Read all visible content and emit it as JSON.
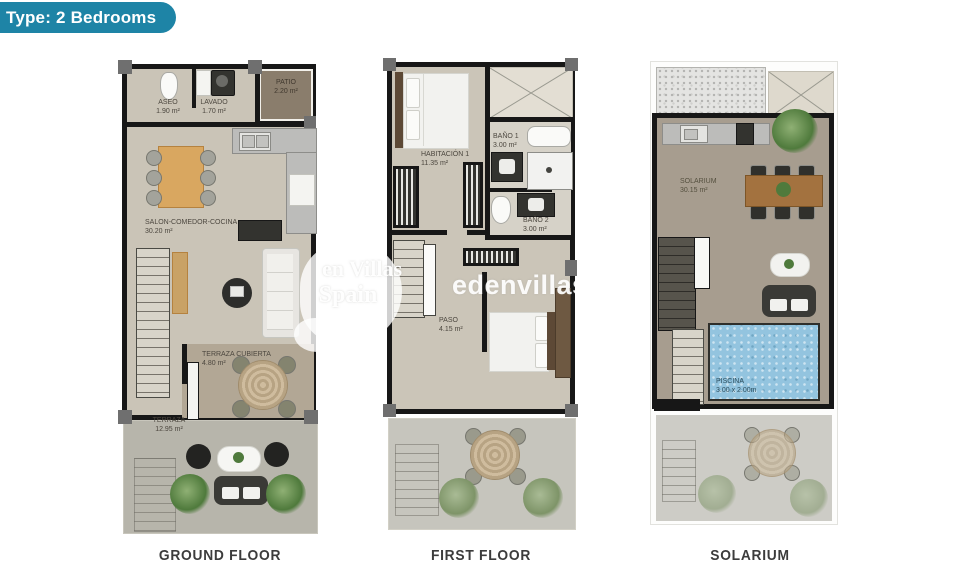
{
  "badge": {
    "label": "Type: 2 Bedrooms"
  },
  "watermark": {
    "logo_line1": "en Villas",
    "logo_line2": "Spain",
    "site_text": "edenvillasspain"
  },
  "plans": [
    {
      "caption": "GROUND FLOOR",
      "rooms": [
        {
          "name": "ASEO",
          "area": "1.90 m²"
        },
        {
          "name": "LAVADO",
          "area": "1.70 m²"
        },
        {
          "name": "PATIO",
          "area": "2.20 m²"
        },
        {
          "name": "SALON-COMEDOR-COCINA",
          "area": "30.20 m²"
        },
        {
          "name": "TERRAZA CUBIERTA",
          "area": "4.80 m²"
        },
        {
          "name": "TERRAZA",
          "area": "12.95 m²"
        }
      ]
    },
    {
      "caption": "FIRST FLOOR",
      "rooms": [
        {
          "name": "HABITACIÓN 1",
          "area": "11.35 m²"
        },
        {
          "name": "BAÑO 1",
          "area": "3.00 m²"
        },
        {
          "name": "BAÑO 2",
          "area": "3.00 m²"
        },
        {
          "name": "PASO",
          "area": "4.15 m²"
        }
      ]
    },
    {
      "caption": "SOLARIUM",
      "rooms": [
        {
          "name": "SOLARIUM",
          "area": "30.15 m²"
        },
        {
          "name": "PISCINA",
          "area": "3.00 x 2.00m"
        }
      ]
    }
  ],
  "colors": {
    "badge_teal": "#1e84a6",
    "wall_black": "#171717",
    "floor_beige": "#cac4b7",
    "patio_brown": "#8a7d6c",
    "pool_blue": "#93c4df",
    "wood": "#d9a760"
  }
}
